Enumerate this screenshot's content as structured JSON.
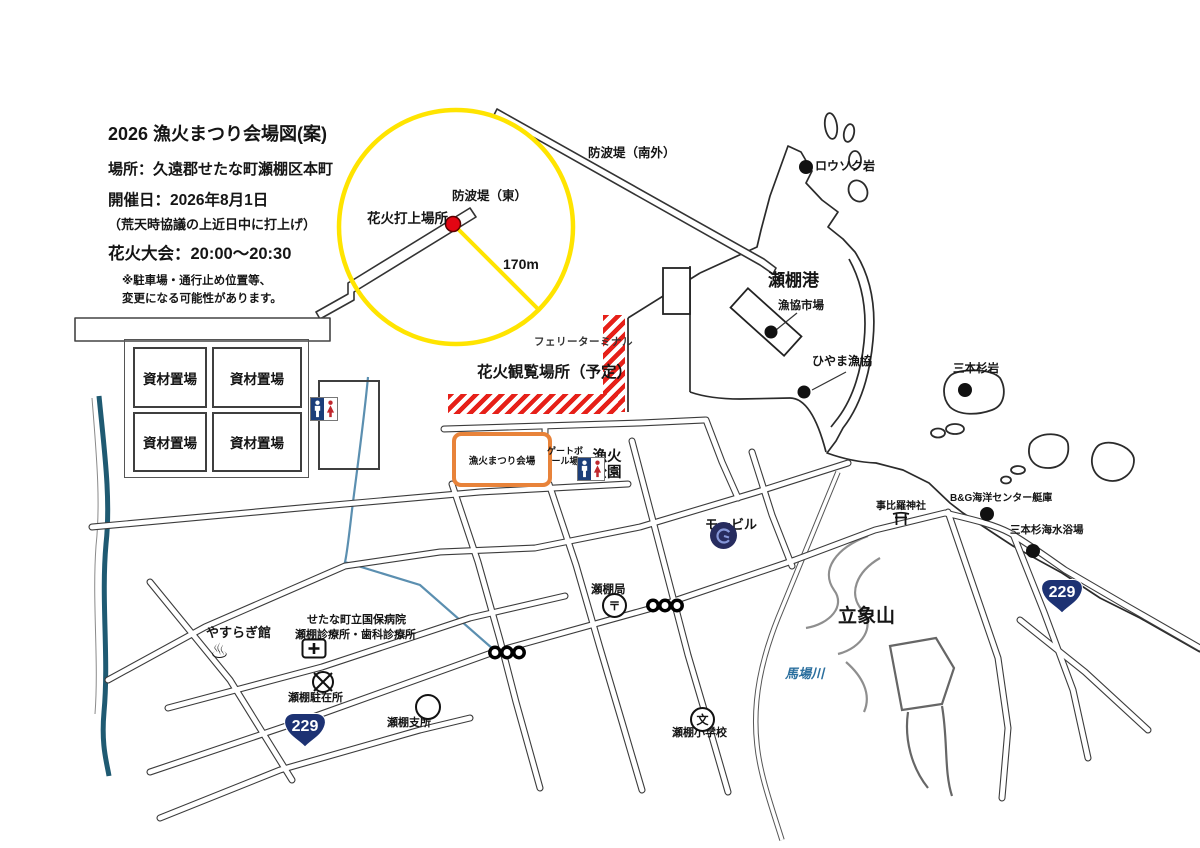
{
  "header": {
    "title": "2026 漁火まつり会場図(案)",
    "location": "場所：久遠郡せたな町瀬棚区本町",
    "date": "開催日：2026年8月1日",
    "weather_note": "（荒天時協議の上近日中に打上げ）",
    "event_time": "花火大会：20:00～20:30",
    "disclaimer_line1": "※駐車場・通行止め位置等、",
    "disclaimer_line2": "変更になる可能性があります。"
  },
  "map": {
    "launch_label": "花火打上場所",
    "radius_label": "170m",
    "breakwater_east": "防波堤（東）",
    "breakwater_south": "防波堤（南外）",
    "viewing_area": "花火観覧場所（予定）",
    "ferry_terminal": "フェリーターミナル",
    "venue_box": "漁火まつり会場",
    "storage_label": "資材置場",
    "gateball": "ゲートボール場",
    "park": "漁火公園",
    "port": "瀬棚港",
    "fish_market": "漁協市場",
    "candle_rock": "ロウソク岩",
    "hiyama_coop": "ひやま漁協",
    "sanbonsugi_rock": "三本杉岩",
    "bg_center": "B&G海洋センター艇庫",
    "kotohira_shrine": "事比羅神社",
    "sanbonsugi_beach": "三本杉海水浴場",
    "mount_rissho": "立象山",
    "baba_river": "馬場川",
    "mobil": "モービル",
    "post_office": "瀬棚局",
    "elementary_school": "瀬棚小学校",
    "yasuragi_hall": "やすらぎ館",
    "hospital_line1": "せたな町立国保病院",
    "hospital_line2": "瀬棚診療所・歯科診療所",
    "police_box": "瀬棚駐在所",
    "branch_office": "瀬棚支所",
    "route_number": "229",
    "symbols": {
      "post_mark": "〒",
      "school_mark": "文",
      "onsen_mark": "♨"
    }
  },
  "colors": {
    "safety_circle_yellow": "#ffe400",
    "restricted_area_red": "#e62019",
    "venue_border_orange": "#e8833a",
    "route_shield_navy": "#1d3273",
    "river_teal": "#1f5a72",
    "stream_blue": "#5b8fb0",
    "mobil_navy": "#272c5f",
    "launch_dot_red": "#e30613"
  }
}
